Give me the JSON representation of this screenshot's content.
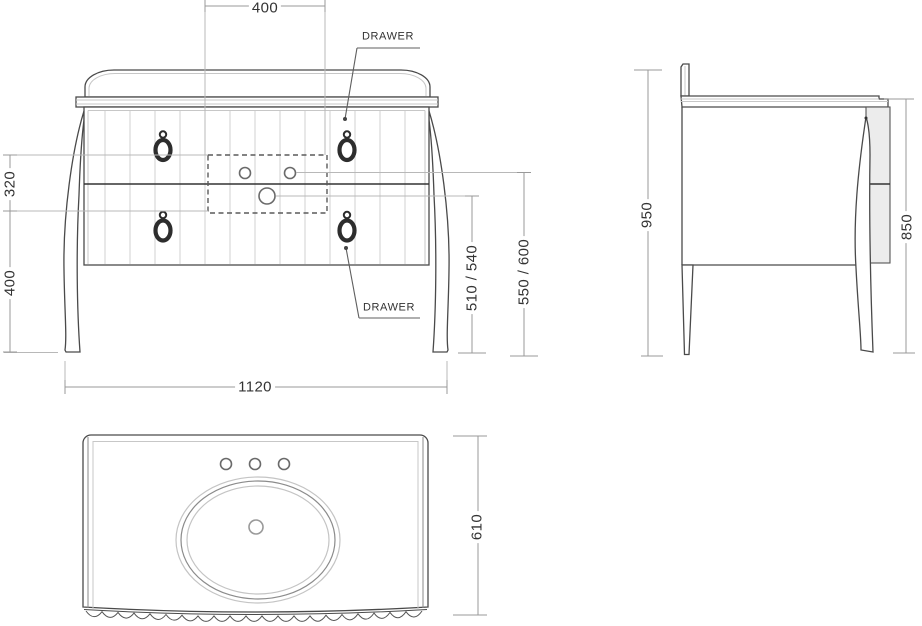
{
  "views": {
    "front": {
      "dims": {
        "cutout_width": "400",
        "left_upper": "320",
        "left_lower": "400",
        "overall_width": "1120",
        "drain_height": "510 / 540",
        "faucet_height": "550 / 600"
      },
      "callouts": {
        "upper_drawer": "DRAWER",
        "lower_drawer": "DRAWER"
      }
    },
    "side": {
      "dims": {
        "total_height": "950",
        "worktop_height": "850"
      }
    },
    "top": {
      "dims": {
        "depth": "610"
      }
    }
  },
  "colors": {
    "background": "#ffffff",
    "line": "#4a4a4a",
    "line_light": "#b8b8b8",
    "dimension_line": "#999999",
    "text": "#333333",
    "panel_fill": "#ececec"
  }
}
